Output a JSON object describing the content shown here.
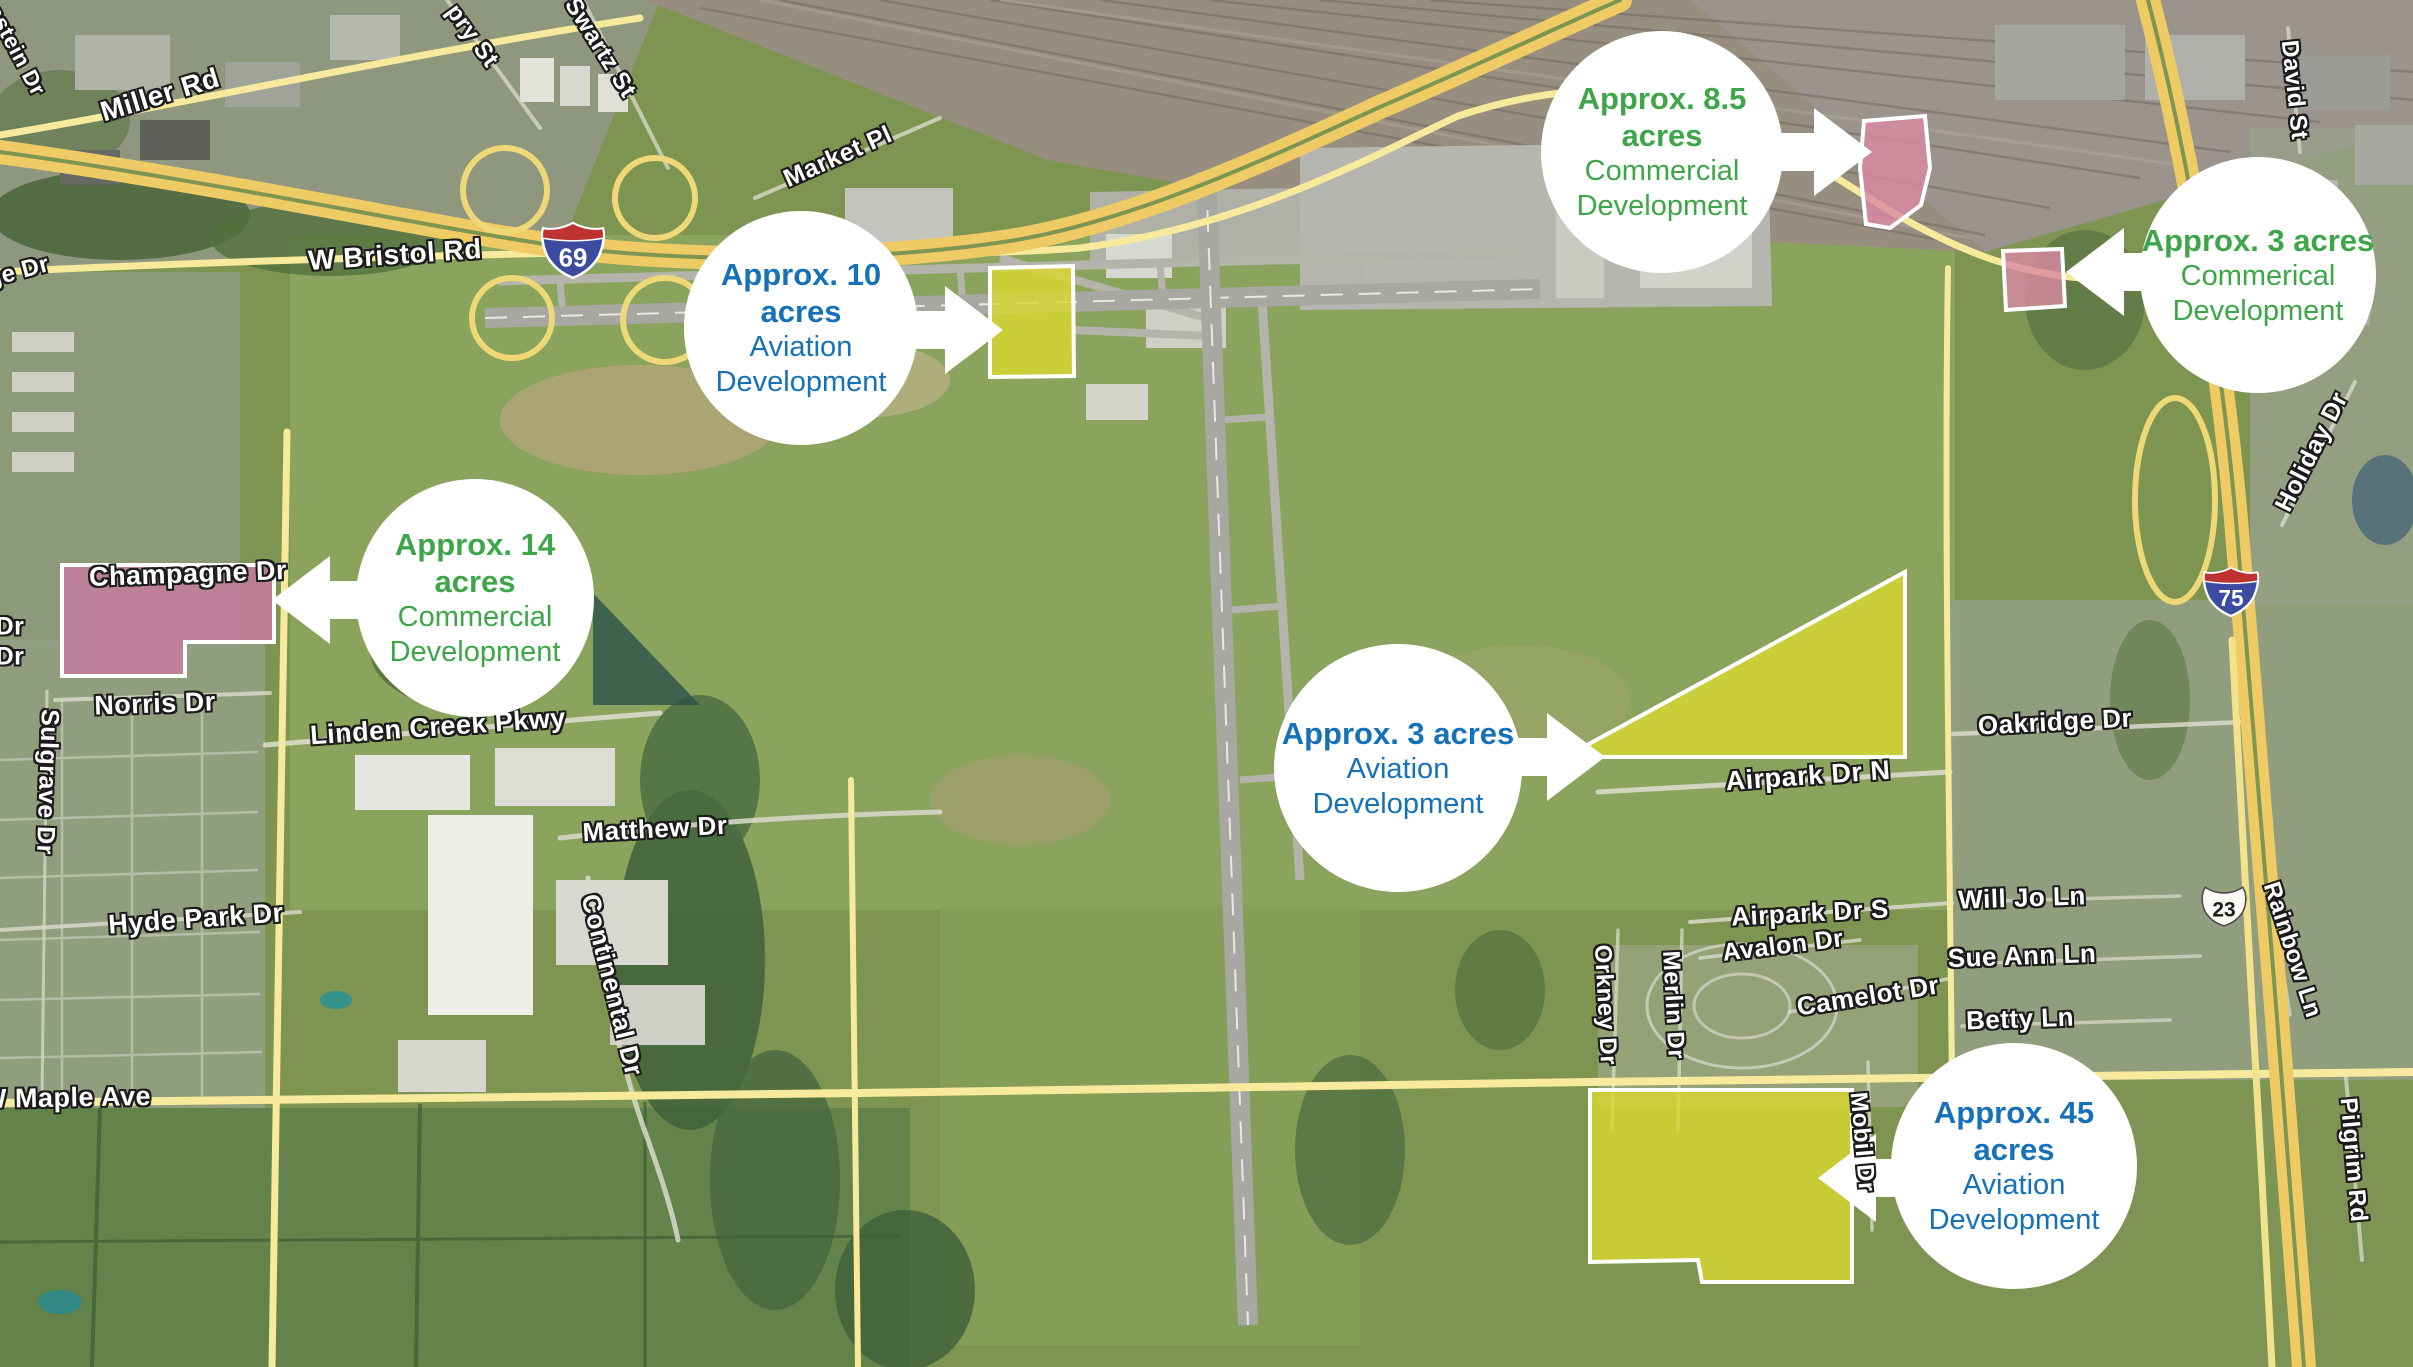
{
  "map": {
    "callouts": [
      {
        "id": "aviation-10-acres",
        "acres": "Approx. 10 acres",
        "line1": "Aviation",
        "line2": "Development",
        "color": "#1571B8",
        "cx": 801,
        "cy": 328,
        "r": 117,
        "dir": "right",
        "ax": 1003,
        "ay": 330
      },
      {
        "id": "commercial-8-5-acres",
        "acres": "Approx. 8.5 acres",
        "line1": "Commercial",
        "line2": "Development",
        "color": "#3EA648",
        "cx": 1662,
        "cy": 152,
        "r": 121,
        "dir": "right",
        "ax": 1872,
        "ay": 152
      },
      {
        "id": "commercial-3-acres",
        "acres": "Approx. 3 acres",
        "line1": "Commerical",
        "line2": "Development",
        "color": "#3EA648",
        "cx": 2258,
        "cy": 275,
        "r": 118,
        "dir": "left",
        "ax": 2066,
        "ay": 272
      },
      {
        "id": "commercial-14-acres",
        "acres": "Approx. 14 acres",
        "line1": "Commercial",
        "line2": "Development",
        "color": "#3EA648",
        "cx": 475,
        "cy": 598,
        "r": 119,
        "dir": "left",
        "ax": 272,
        "ay": 600
      },
      {
        "id": "aviation-3-acres",
        "acres": "Approx. 3 acres",
        "line1": "Aviation",
        "line2": "Development",
        "color": "#1571B8",
        "cx": 1398,
        "cy": 768,
        "r": 124,
        "dir": "right",
        "ax": 1605,
        "ay": 757
      },
      {
        "id": "aviation-45-acres",
        "acres": "Approx. 45 acres",
        "line1": "Aviation",
        "line2": "Development",
        "color": "#1571B8",
        "cx": 2014,
        "cy": 1166,
        "r": 123,
        "dir": "left",
        "ax": 1818,
        "ay": 1178
      }
    ],
    "parcels": [
      {
        "id": "aviation-10-acres",
        "points": "990,268 1073,266 1074,376 990,377",
        "fill": "#D9D92F",
        "opacity": 0.8
      },
      {
        "id": "commercial-8-5-acres",
        "points": "1864,121 1925,116 1930,168 1921,205 1890,228 1866,224 1860,168",
        "fill": "#DA8AA2",
        "opacity": 0.8
      },
      {
        "id": "commercial-3-acres",
        "points": "2003,251 2062,249 2065,306 2006,310",
        "fill": "#DA8AA2",
        "opacity": 0.8
      },
      {
        "id": "commercial-14-acres",
        "points": "62,565 274,565 274,642 185,642 185,676 62,676",
        "fill": "#C47C9D",
        "opacity": 0.85
      },
      {
        "id": "aviation-3-acres",
        "points": "1565,757 1905,572 1905,757",
        "fill": "#D9D92F",
        "opacity": 0.8
      },
      {
        "id": "aviation-45-acres",
        "points": "1590,1090 1852,1090 1852,1282 1702,1282 1698,1260 1590,1262",
        "fill": "#D9D92F",
        "opacity": 0.8
      }
    ],
    "street_labels": [
      {
        "text": "Miller Rd",
        "x": 160,
        "y": 95,
        "rot": -17,
        "size": 28
      },
      {
        "text": "pry St",
        "x": 472,
        "y": 36,
        "rot": 54,
        "size": 24
      },
      {
        "text": "Swartz St",
        "x": 600,
        "y": 48,
        "rot": 58,
        "size": 24
      },
      {
        "text": "Market Pl",
        "x": 838,
        "y": 157,
        "rot": -24,
        "size": 25
      },
      {
        "text": "W Bristol Rd",
        "x": 395,
        "y": 255,
        "rot": -4,
        "size": 28
      },
      {
        "text": "ge Dr",
        "x": 18,
        "y": 272,
        "rot": -15,
        "size": 24
      },
      {
        "text": "nstein Dr",
        "x": 16,
        "y": 50,
        "rot": 62,
        "size": 22
      },
      {
        "text": "Champagne Dr",
        "x": 188,
        "y": 574,
        "rot": -2,
        "size": 27
      },
      {
        "text": "Dr",
        "x": 10,
        "y": 627,
        "rot": 0,
        "size": 25
      },
      {
        "text": "Dr",
        "x": 10,
        "y": 657,
        "rot": 0,
        "size": 25
      },
      {
        "text": "Norris Dr",
        "x": 155,
        "y": 704,
        "rot": -2,
        "size": 27
      },
      {
        "text": "Sulgrave Dr",
        "x": 47,
        "y": 782,
        "rot": 92,
        "size": 25
      },
      {
        "text": "Linden Creek Pkwy",
        "x": 438,
        "y": 727,
        "rot": -4,
        "size": 27
      },
      {
        "text": "Matthew Dr",
        "x": 655,
        "y": 829,
        "rot": -3,
        "size": 26
      },
      {
        "text": "Continental Dr",
        "x": 612,
        "y": 985,
        "rot": 76,
        "size": 26
      },
      {
        "text": "Hyde Park Dr",
        "x": 196,
        "y": 919,
        "rot": -4,
        "size": 27
      },
      {
        "text": "W Maple Ave",
        "x": 66,
        "y": 1098,
        "rot": -1,
        "size": 27
      },
      {
        "text": "Airpark Dr N",
        "x": 1808,
        "y": 776,
        "rot": -4,
        "size": 27
      },
      {
        "text": "Oakridge Dr",
        "x": 2055,
        "y": 722,
        "rot": -3,
        "size": 26
      },
      {
        "text": "Airpark Dr S",
        "x": 1810,
        "y": 913,
        "rot": -3,
        "size": 26
      },
      {
        "text": "Avalon Dr",
        "x": 1783,
        "y": 946,
        "rot": -7,
        "size": 25
      },
      {
        "text": "Camelot Dr",
        "x": 1868,
        "y": 996,
        "rot": -9,
        "size": 26
      },
      {
        "text": "Will Jo Ln",
        "x": 2022,
        "y": 898,
        "rot": -2,
        "size": 26
      },
      {
        "text": "Sue Ann Ln",
        "x": 2022,
        "y": 956,
        "rot": -2,
        "size": 26
      },
      {
        "text": "Betty Ln",
        "x": 2020,
        "y": 1019,
        "rot": -2,
        "size": 26
      },
      {
        "text": "Orkney Dr",
        "x": 1605,
        "y": 1005,
        "rot": 87,
        "size": 24
      },
      {
        "text": "Merlin Dr",
        "x": 1673,
        "y": 1005,
        "rot": 87,
        "size": 24
      },
      {
        "text": "Mobil Dr",
        "x": 1862,
        "y": 1142,
        "rot": 85,
        "size": 24
      },
      {
        "text": "Holiday Dr",
        "x": 2312,
        "y": 452,
        "rot": -63,
        "size": 25
      },
      {
        "text": "Rainbow Ln",
        "x": 2292,
        "y": 950,
        "rot": 72,
        "size": 24
      },
      {
        "text": "Pilgrim Rd",
        "x": 2353,
        "y": 1160,
        "rot": 85,
        "size": 24
      },
      {
        "text": "David St",
        "x": 2294,
        "y": 90,
        "rot": 84,
        "size": 24
      }
    ],
    "shields": [
      {
        "type": "interstate",
        "number": "69",
        "x": 573,
        "y": 250,
        "w": 66,
        "h": 60
      },
      {
        "type": "interstate",
        "number": "75",
        "x": 2231,
        "y": 591,
        "w": 58,
        "h": 53
      },
      {
        "type": "us",
        "number": "23",
        "x": 2224,
        "y": 906,
        "w": 48,
        "h": 44
      }
    ]
  }
}
